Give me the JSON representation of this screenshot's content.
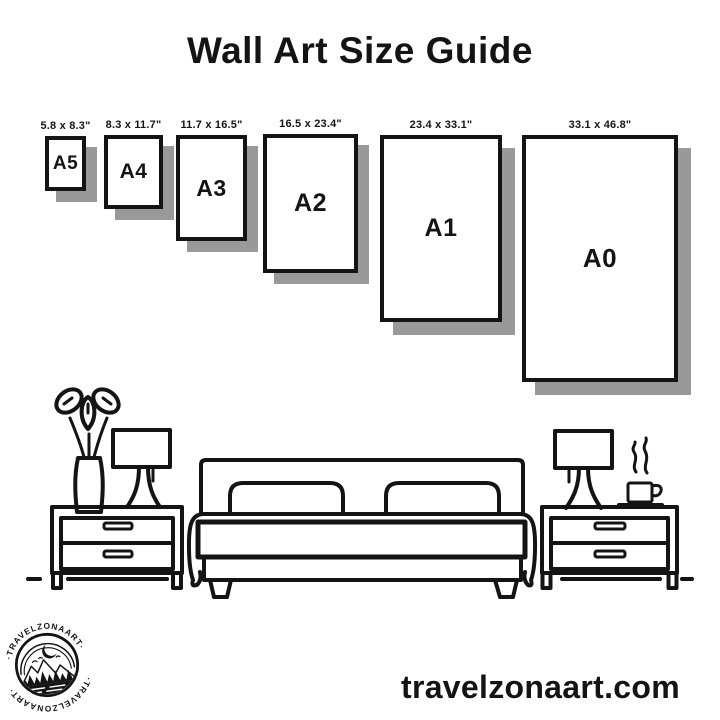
{
  "page": {
    "title": "Wall Art Size Guide",
    "website_url": "travelzonaart.com"
  },
  "colors": {
    "ink": "#141414",
    "shadow": "#999999",
    "background": "#ffffff"
  },
  "sizes": [
    {
      "code": "A5",
      "dimensions": "5.8 x 8.3\""
    },
    {
      "code": "A4",
      "dimensions": "8.3 x 11.7\""
    },
    {
      "code": "A3",
      "dimensions": "11.7 x 16.5\""
    },
    {
      "code": "A2",
      "dimensions": "16.5 x 23.4\""
    },
    {
      "code": "A1",
      "dimensions": "23.4 x 33.1\""
    },
    {
      "code": "A0",
      "dimensions": "33.1 x 46.8\""
    }
  ],
  "badge": {
    "arc_text_top": "·TRAVELZONAART·",
    "arc_text_bottom": "·TRAVELZONAART·"
  }
}
